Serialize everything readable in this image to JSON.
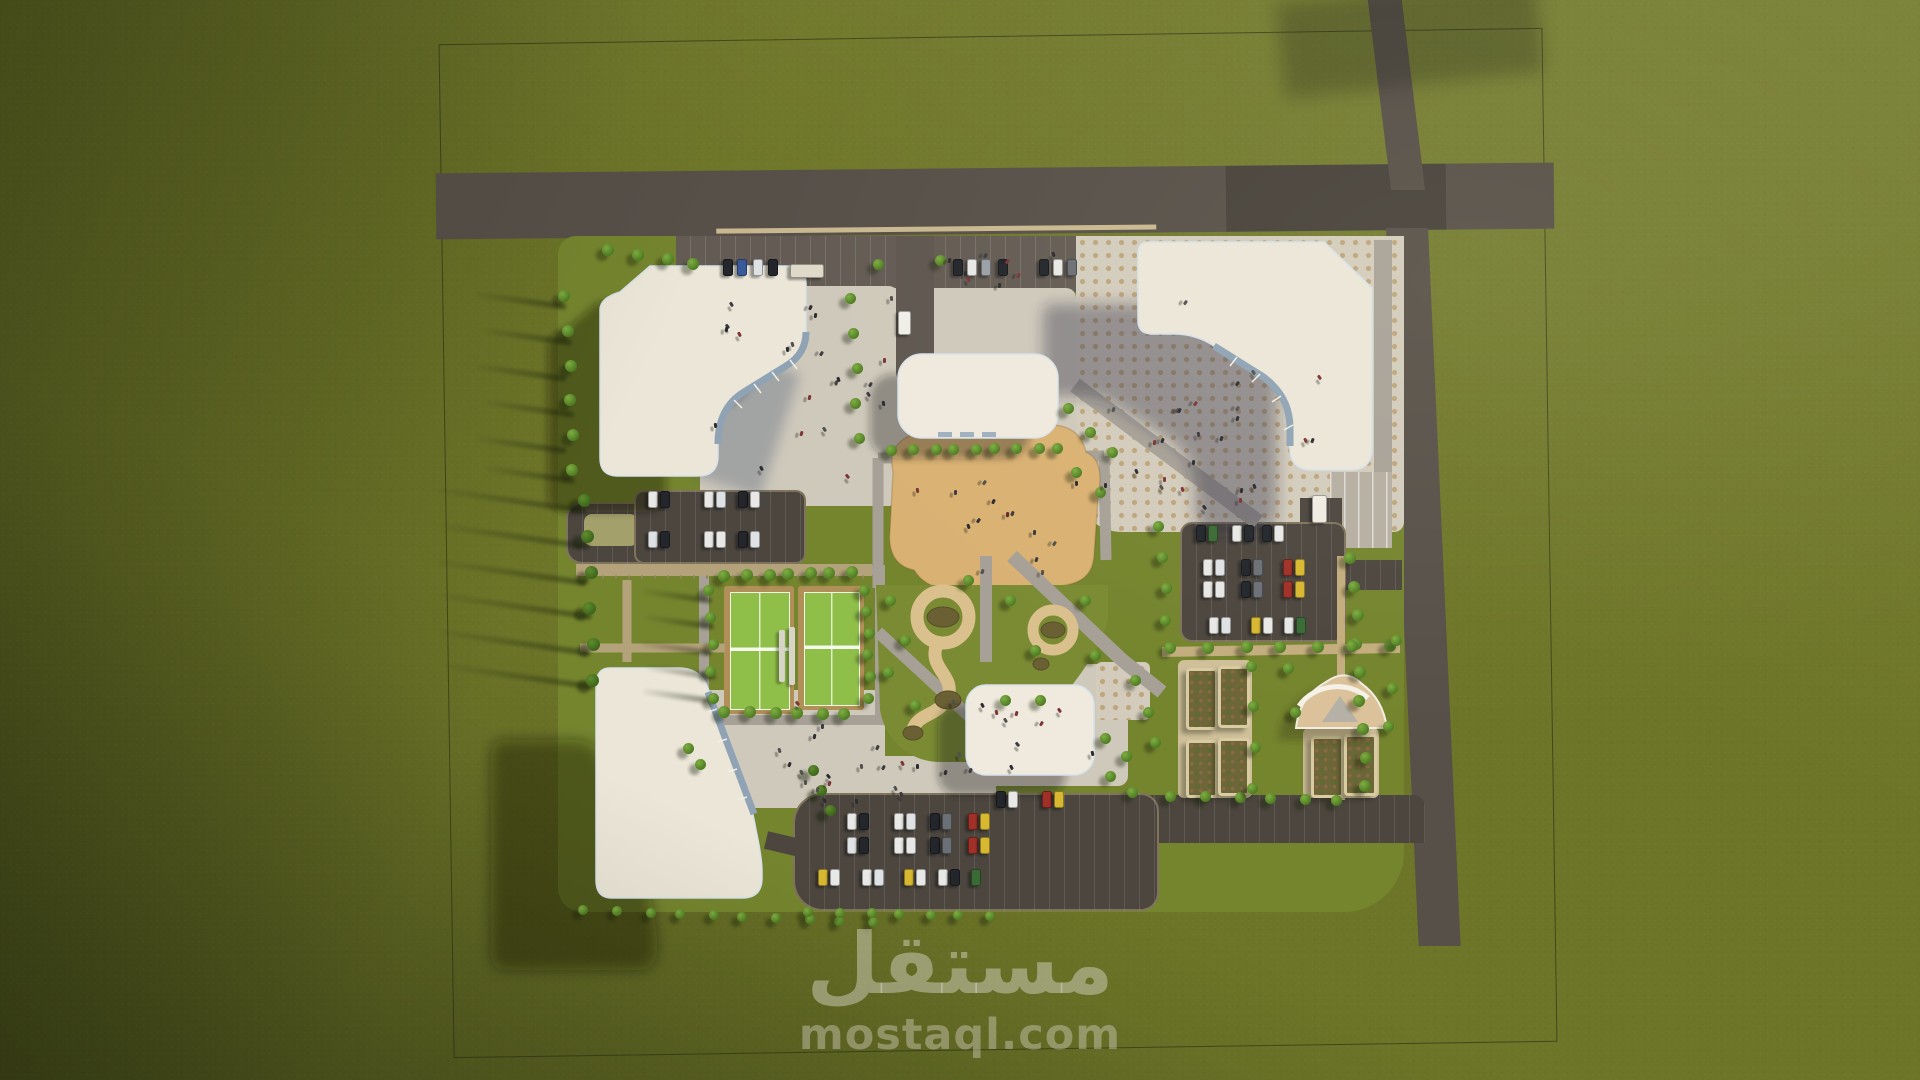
{
  "watermark": {
    "logo_ar": "مستقل",
    "site_domain": "mostaql.com"
  },
  "palette": {
    "grass": "#6d7528",
    "campus_lawn": "#75852e",
    "road": "#575049",
    "asphalt_lot": "#4c463f",
    "plaza": "#cfc9bb",
    "plaza_dot": "#bda57c",
    "sand_deck": "#d9b173",
    "path_tan": "#d9c08c",
    "path_gray": "#a6a097",
    "building_roof": "#ebe6d8",
    "glass_facade": "#8fa3b5",
    "tennis_green": "#8fbe49",
    "tennis_clay": "#b08f58",
    "tree_light": "#7fae42",
    "tree_dark": "#5f8c2e",
    "shadow": "rgba(26,30,14,0.4)",
    "watermark_text": "rgba(216,213,198,0.48)"
  },
  "scene": {
    "description": "Aerial 3D render of a campus master plan on a green field: four cream L-shaped buildings with curved glass facades, two central halls, a tent pavilion, sand deck plaza, curvy garden paths, two tennis courts, garden beds, three car parks and perimeter roads, with long shadows cast to the lower-left.",
    "trees": {
      "rows": [
        {
          "a": [
            726,
            578
          ],
          "b": [
            852,
            574
          ],
          "n": 7,
          "s": 12
        },
        {
          "a": [
            726,
            714
          ],
          "b": [
            846,
            716
          ],
          "n": 6,
          "s": 12
        },
        {
          "a": [
            710,
            592
          ],
          "b": [
            712,
            700
          ],
          "n": 5,
          "s": 11
        },
        {
          "a": [
            866,
            592
          ],
          "b": [
            870,
            700
          ],
          "n": 6,
          "s": 11
        },
        {
          "a": [
            566,
            298
          ],
          "b": [
            574,
            472
          ],
          "n": 6,
          "s": 12
        },
        {
          "a": [
            586,
            502
          ],
          "b": [
            594,
            682
          ],
          "n": 6,
          "s": 13,
          "v": "d"
        },
        {
          "a": [
            610,
            252
          ],
          "b": [
            694,
            266
          ],
          "n": 4,
          "s": 12
        },
        {
          "a": [
            893,
            452
          ],
          "b": [
            1058,
            450
          ],
          "n": 9,
          "s": 11
        },
        {
          "a": [
            852,
            300
          ],
          "b": [
            858,
            440
          ],
          "n": 5,
          "s": 11
        },
        {
          "a": [
            1352,
            560
          ],
          "b": [
            1366,
            788
          ],
          "n": 9,
          "s": 12
        },
        {
          "a": [
            1172,
            650
          ],
          "b": [
            1390,
            648
          ],
          "n": 7,
          "s": 12
        },
        {
          "a": [
            1172,
            798
          ],
          "b": [
            1338,
            802
          ],
          "n": 6,
          "s": 11
        },
        {
          "a": [
            585,
            912
          ],
          "b": [
            872,
            924
          ],
          "n": 10,
          "s": 10
        },
        {
          "a": [
            810,
            914
          ],
          "b": [
            990,
            918
          ],
          "n": 7,
          "s": 10
        },
        {
          "a": [
            1160,
            528
          ],
          "b": [
            1166,
            622
          ],
          "n": 4,
          "s": 11
        },
        {
          "a": [
            1253,
            668
          ],
          "b": [
            1253,
            790
          ],
          "n": 4,
          "s": 11
        },
        {
          "a": [
            815,
            772
          ],
          "b": [
            828,
            812
          ],
          "n": 3,
          "s": 11,
          "v": "d"
        }
      ],
      "singles": [
        [
          1068,
          408
        ],
        [
          1090,
          432
        ],
        [
          1112,
          452
        ],
        [
          1076,
          472
        ],
        [
          1100,
          492
        ],
        [
          1105,
          738
        ],
        [
          1126,
          756
        ],
        [
          1110,
          776
        ],
        [
          1132,
          792
        ],
        [
          1148,
          712
        ],
        [
          890,
          600
        ],
        [
          905,
          640
        ],
        [
          888,
          672
        ],
        [
          915,
          705
        ],
        [
          1010,
          600
        ],
        [
          1035,
          650
        ],
        [
          1085,
          600
        ],
        [
          1095,
          655
        ],
        [
          968,
          580
        ],
        [
          1005,
          700
        ],
        [
          1040,
          700
        ],
        [
          1288,
          668
        ],
        [
          1392,
          688
        ],
        [
          1388,
          726
        ],
        [
          1295,
          712
        ],
        [
          688,
          748
        ],
        [
          700,
          764
        ],
        [
          878,
          264
        ],
        [
          940,
          260
        ],
        [
          1396,
          640
        ],
        [
          1135,
          680
        ],
        [
          1155,
          742
        ]
      ]
    },
    "cars": [
      [
        727,
        266,
        "#23262b"
      ],
      [
        741,
        266,
        "#3a5a9a"
      ],
      [
        757,
        266,
        "#dfe2e4"
      ],
      [
        772,
        266,
        "#23262b"
      ],
      [
        806,
        270,
        "#ded9c8",
        "h",
        32,
        12
      ],
      [
        957,
        266,
        "#23262b"
      ],
      [
        971,
        266,
        "#e8e8e6"
      ],
      [
        985,
        266,
        "#9aa0a6"
      ],
      [
        1002,
        266,
        "#23262b"
      ],
      [
        1043,
        266,
        "#23262b"
      ],
      [
        1057,
        266,
        "#e8e8e6"
      ],
      [
        1071,
        266,
        "#6b7076"
      ],
      [
        903,
        322,
        "#efefe8",
        "v",
        11,
        22
      ],
      [
        652,
        498,
        "#e8e8e6"
      ],
      [
        664,
        498,
        "#23262b"
      ],
      [
        708,
        498,
        "#e8e8e6"
      ],
      [
        720,
        498,
        "#dfe2e4"
      ],
      [
        742,
        498,
        "#23262b"
      ],
      [
        754,
        498,
        "#e8e8e6"
      ],
      [
        652,
        538,
        "#dfe2e4"
      ],
      [
        664,
        538,
        "#23262b"
      ],
      [
        708,
        538,
        "#e8e8e6"
      ],
      [
        720,
        538,
        "#e8e8e6"
      ],
      [
        742,
        538,
        "#23262b"
      ],
      [
        754,
        538,
        "#dfe2e4"
      ],
      [
        1200,
        532,
        "#23262b"
      ],
      [
        1212,
        532,
        "#3a6a35"
      ],
      [
        1236,
        532,
        "#e8e8e6"
      ],
      [
        1248,
        532,
        "#23262b"
      ],
      [
        1266,
        532,
        "#23262b"
      ],
      [
        1278,
        532,
        "#e8e8e6"
      ],
      [
        1207,
        566,
        "#e8e8e6"
      ],
      [
        1219,
        566,
        "#dfe2e4"
      ],
      [
        1245,
        566,
        "#23262b"
      ],
      [
        1257,
        566,
        "#6b7076"
      ],
      [
        1287,
        566,
        "#a03028"
      ],
      [
        1299,
        566,
        "#d8b830"
      ],
      [
        1207,
        588,
        "#e8e8e6"
      ],
      [
        1219,
        588,
        "#e8e8e6"
      ],
      [
        1245,
        588,
        "#23262b"
      ],
      [
        1257,
        588,
        "#6b7076"
      ],
      [
        1287,
        588,
        "#a03028"
      ],
      [
        1299,
        588,
        "#d8b830"
      ],
      [
        1213,
        624,
        "#e8e8e6"
      ],
      [
        1225,
        624,
        "#dfe2e4"
      ],
      [
        1255,
        624,
        "#d8b830"
      ],
      [
        1267,
        624,
        "#e8e8e6"
      ],
      [
        1288,
        624,
        "#e8e8e6"
      ],
      [
        1300,
        624,
        "#3a6a35"
      ],
      [
        1318,
        508,
        "#efece2",
        "v",
        13,
        26
      ],
      [
        851,
        820,
        "#e8e8e6"
      ],
      [
        863,
        820,
        "#23262b"
      ],
      [
        898,
        820,
        "#e8e8e6"
      ],
      [
        910,
        820,
        "#dfe2e4"
      ],
      [
        934,
        820,
        "#23262b"
      ],
      [
        946,
        820,
        "#6b7076"
      ],
      [
        972,
        820,
        "#a03028"
      ],
      [
        984,
        820,
        "#d8b830"
      ],
      [
        851,
        844,
        "#dfe2e4"
      ],
      [
        863,
        844,
        "#23262b"
      ],
      [
        898,
        844,
        "#e8e8e6"
      ],
      [
        910,
        844,
        "#e8e8e6"
      ],
      [
        934,
        844,
        "#23262b"
      ],
      [
        946,
        844,
        "#6b7076"
      ],
      [
        972,
        844,
        "#a03028"
      ],
      [
        984,
        844,
        "#d8b830"
      ],
      [
        822,
        876,
        "#d8b830"
      ],
      [
        834,
        876,
        "#e8e8e6"
      ],
      [
        866,
        876,
        "#e8e8e6"
      ],
      [
        878,
        876,
        "#dfe2e4"
      ],
      [
        908,
        876,
        "#d8b830"
      ],
      [
        920,
        876,
        "#e8e8e6"
      ],
      [
        942,
        876,
        "#e8e8e6"
      ],
      [
        954,
        876,
        "#23262b"
      ],
      [
        975,
        876,
        "#3a6a35"
      ],
      [
        1000,
        798,
        "#23262b"
      ],
      [
        1012,
        798,
        "#e8e8e6"
      ],
      [
        1046,
        798,
        "#a03028"
      ],
      [
        1058,
        798,
        "#d8b830"
      ]
    ],
    "people_regions": [
      [
        706,
        296,
        190,
        185,
        22
      ],
      [
        1092,
        300,
        230,
        215,
        26
      ],
      [
        905,
        250,
        150,
        34,
        8
      ],
      [
        905,
        478,
        180,
        95,
        14
      ],
      [
        950,
        695,
        160,
        85,
        12
      ],
      [
        772,
        700,
        105,
        100,
        12
      ],
      [
        824,
        760,
        160,
        34,
        8
      ]
    ],
    "garden_beds": [
      [
        1186,
        668,
        26,
        56
      ],
      [
        1218,
        666,
        26,
        56
      ],
      [
        1186,
        740,
        26,
        52
      ],
      [
        1218,
        738,
        26,
        52
      ],
      [
        1311,
        736,
        27,
        56
      ],
      [
        1344,
        734,
        27,
        56
      ]
    ],
    "tree_shadows": [
      [
        586,
        508,
        150
      ],
      [
        590,
        544,
        150
      ],
      [
        586,
        580,
        150
      ],
      [
        592,
        614,
        150
      ],
      [
        588,
        650,
        150
      ],
      [
        594,
        684,
        150
      ],
      [
        566,
        304,
        90
      ],
      [
        572,
        340,
        90
      ],
      [
        566,
        376,
        90
      ],
      [
        574,
        412,
        90
      ],
      [
        566,
        448,
        90
      ],
      [
        575,
        478,
        90
      ],
      [
        712,
        598,
        70
      ],
      [
        714,
        624,
        70
      ],
      [
        710,
        650,
        70
      ],
      [
        716,
        674,
        70
      ],
      [
        712,
        698,
        70
      ]
    ]
  }
}
